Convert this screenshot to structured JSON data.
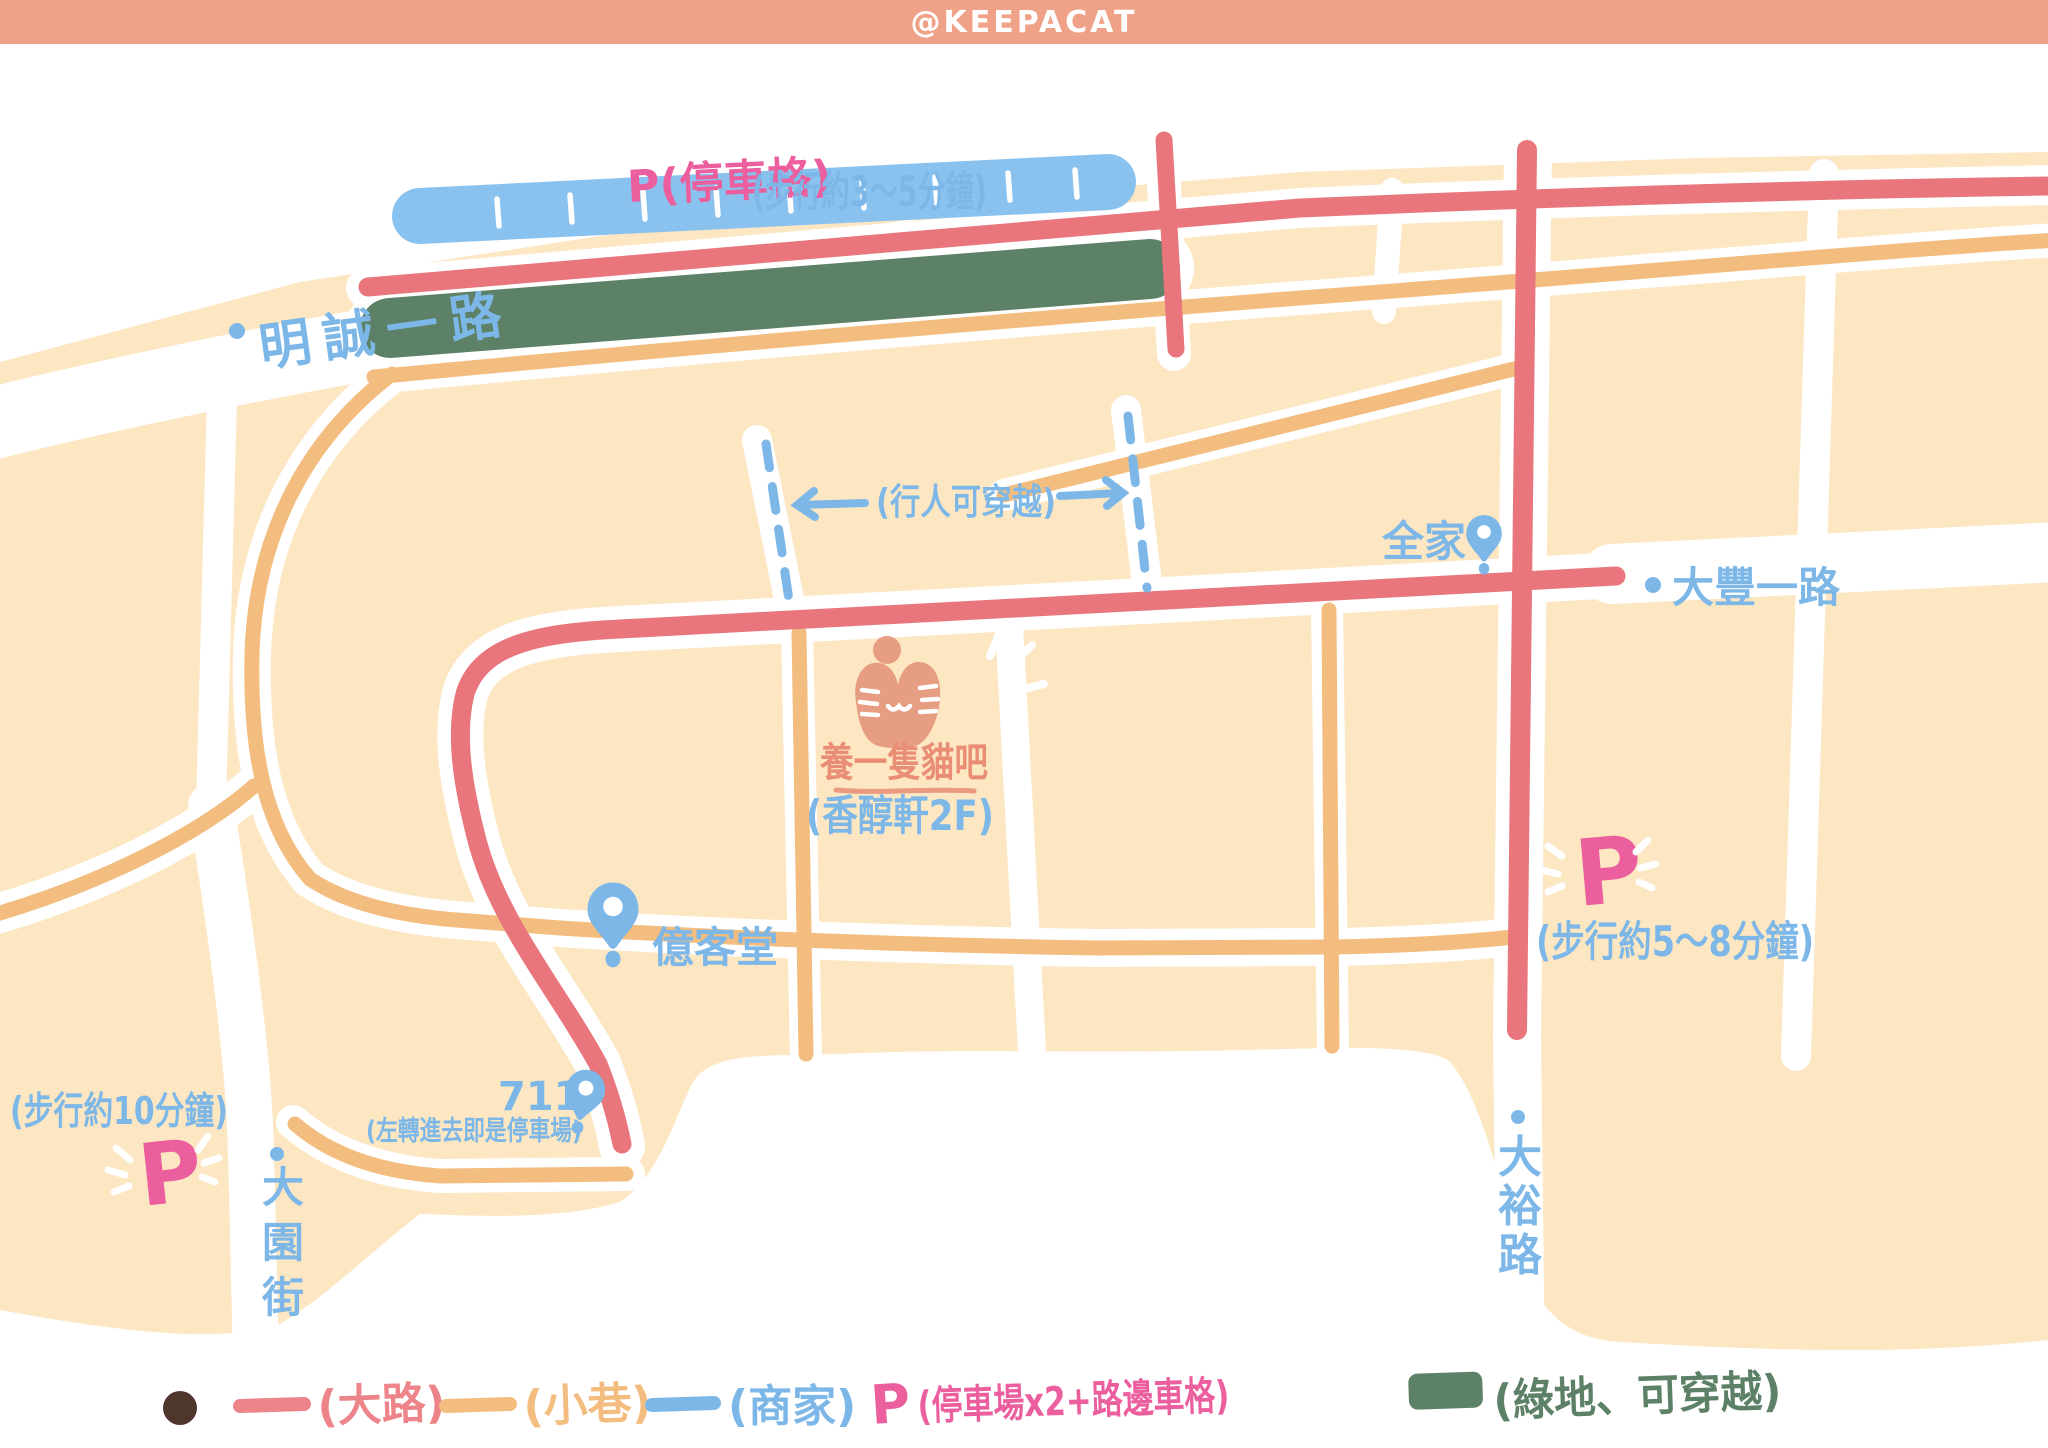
{
  "header": {
    "watermark": "@KEEPACAT"
  },
  "colors": {
    "header_bg": "#efa287",
    "block_cream": "#fce7c2",
    "road_main_red": "#e8767c",
    "road_alley_orange": "#f3bd7f",
    "label_blue": "#7db7e8",
    "parking_strip_blue": "#8ac2ef",
    "green_area": "#5c8166",
    "parking_pink": "#ec5f9f",
    "cafe_salmon": "#e98e75",
    "cat_icon": "#e79d82",
    "legend_dot_brown": "#4f362c"
  },
  "map": {
    "parking_top": {
      "p": "P(停車格)",
      "walk": "(步行約3～5分鐘)"
    },
    "streets": {
      "mingcheng": "明誠一路",
      "dafeng": "大豐一路",
      "dayuan": "大園街",
      "dayu": "大裕路"
    },
    "pedestrian": {
      "note": "(行人可穿越)"
    },
    "pois": {
      "family_mart": "全家",
      "cafe_name": "養一隻貓吧",
      "cafe_floor": "(香醇軒2F)",
      "yiketang": "億客堂",
      "seven11": "711",
      "seven11_note": "(左轉進去即是停車場)"
    },
    "parking_left": {
      "walk": "(步行約10分鐘)",
      "p": "P"
    },
    "parking_right": {
      "p": "P",
      "walk": "(步行約5～8分鐘)"
    }
  },
  "legend": {
    "items": [
      {
        "swatch": "red-dash",
        "label": "(大路)"
      },
      {
        "swatch": "orange-dash",
        "label": "(小巷)"
      },
      {
        "swatch": "blue-dash",
        "label": "(商家)"
      },
      {
        "swatch": "pink-p",
        "p": "P",
        "label": "(停車場x2+路邊車格)"
      },
      {
        "swatch": "green-square",
        "label": "(綠地、可穿越)"
      }
    ]
  }
}
